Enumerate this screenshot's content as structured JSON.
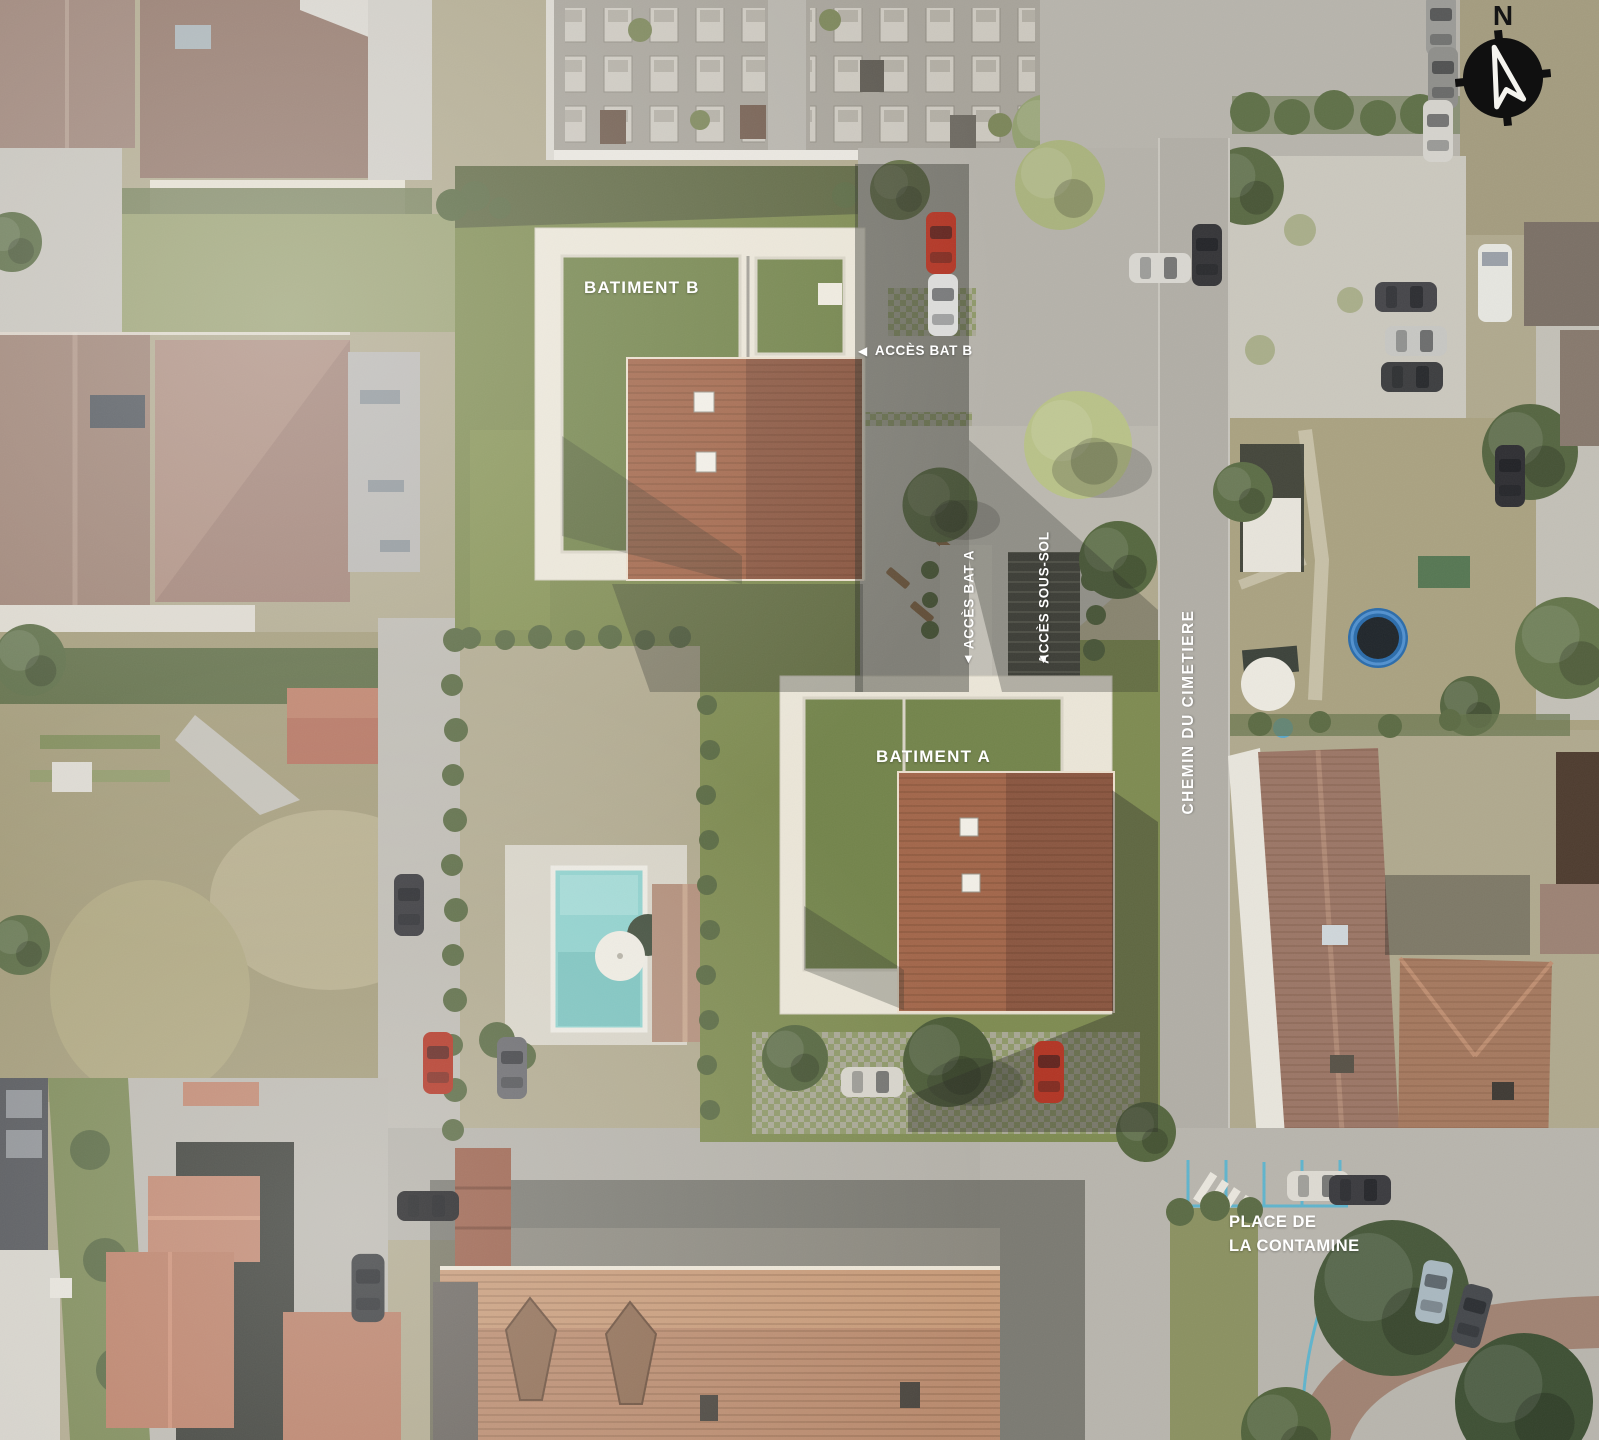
{
  "plan": {
    "type": "aerial-site-plan",
    "labels": {
      "building_b": "BATIMENT B",
      "building_a": "BATIMENT A",
      "access_building_b": "ACCÈS BAT B",
      "access_building_a": "ACCÈS BAT A",
      "access_basement": "ACCÈS SOUS-SOL",
      "street_vertical": "CHEMIN DU CIMETIERE",
      "square_line1": "PLACE DE",
      "square_line2": "LA CONTAMINE"
    },
    "icons": {
      "arrow_left": "◀",
      "arrow_down": "▼",
      "compass_north_letter": "N"
    },
    "colors": {
      "label_text": "#ffffff",
      "site_lawn_green": "#7e8b51",
      "green_roof": "#73844b",
      "tile_roof_brown": "#9a6248",
      "flat_roof_white": "#ebe6d8",
      "asphalt_grey": "#b5b2aa",
      "pool_water": "#8fd1cd",
      "parking_line_blue": "#5fb4cd",
      "compass_black": "#101010",
      "red_car": "#b23524"
    }
  }
}
